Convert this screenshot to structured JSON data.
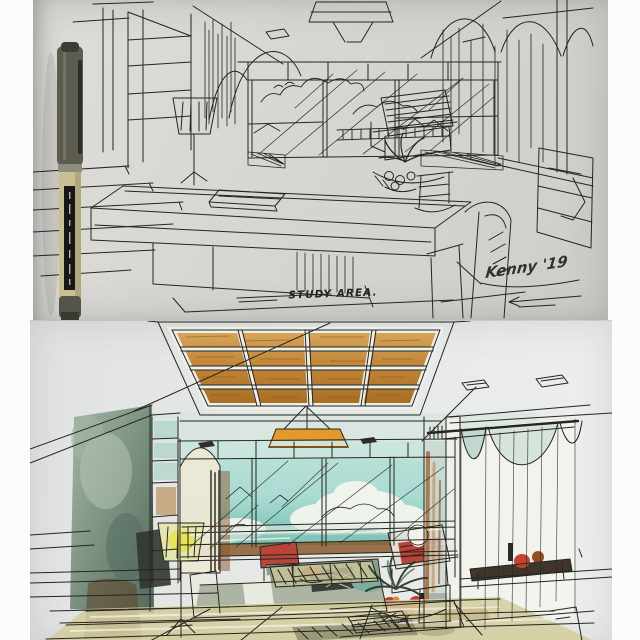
{
  "collage": {
    "top_photo": {
      "label_text": "STUDY AREA.",
      "signature_text": "Kenny '19"
    },
    "bottom_photo": {}
  },
  "palette": {
    "ink": "#26251f",
    "pen_cap": "#5c5b50",
    "pen_barrel": "#c9bf93",
    "wood_light": "#d9a75c",
    "wood_dark": "#a66d22",
    "pendant_orange": "#e39a2c",
    "sky_light": "#a8dbd2",
    "sky_deep": "#6fbdb2",
    "cloud_white": "#f3f6ee",
    "wall_light": "#a4b7a8",
    "wall_dark": "#54695b",
    "lamp_shade": "#e3e7ad",
    "lamp_glow": "#e8e34c",
    "sofa_green": "#8f9e8c",
    "floor_tan": "#d3cd9c",
    "accent_red": "#b8453b",
    "curtain_rust": "#a8622f"
  }
}
